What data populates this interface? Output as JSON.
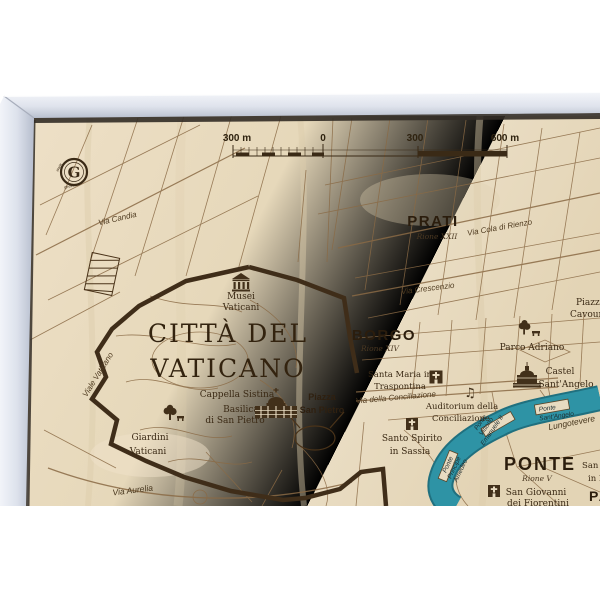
{
  "map": {
    "logo": {
      "letter": "G",
      "ring_left": "www",
      "ring_bottom": "geckoart"
    },
    "scale_bar": {
      "labels": [
        "300 m",
        "0",
        "300",
        "600 m"
      ]
    },
    "title": {
      "line1": "CITTÀ DEL",
      "line2": "VATICANO"
    },
    "districts": {
      "prati": {
        "name": "PRATI",
        "rione": "Rione XXII"
      },
      "borgo": {
        "name": "BORGO",
        "rione": "Rione XIV"
      },
      "ponte": {
        "name": "PONTE",
        "rione": "Rione V"
      },
      "parione": {
        "name": "PARIONE"
      }
    },
    "streets": {
      "via_candia": "Via Candia",
      "via_cola_di_rienzo": "Via Cola di Rienzo",
      "via_crescenzio": "Via Crescenzio",
      "viale_vaticano": "Viale Vaticano",
      "via_della_conciliazione": "Via della Conciliazione",
      "via_aurelia": "Via Aurelia",
      "lungotevere": "Lungotevere"
    },
    "bridges": {
      "vittorio_emanuele": {
        "line1": "Ponte",
        "line2": "Vittorio",
        "line3": "Emanuele II"
      },
      "sant_angelo": {
        "line1": "Ponte",
        "line2": "Sant'Angelo"
      },
      "principe_amedeo": {
        "line1": "Ponte",
        "line2": "Principe",
        "line3": "Amedeo"
      }
    },
    "pois": {
      "musei_vaticani": {
        "line1": "Musei",
        "line2": "Vaticani"
      },
      "cappella_sistina": {
        "line1": "Cappella Sistina"
      },
      "basilica_san_pietro": {
        "line1": "Basilica",
        "line2": "di San Pietro"
      },
      "piazza_san_pietro": {
        "line1": "Piazza",
        "line2": "San Pietro"
      },
      "giardini_vaticani": {
        "line1": "Giardini",
        "line2": "Vaticani"
      },
      "santa_maria_traspontina": {
        "line1": "Santa Maria in",
        "line2": "Traspontina"
      },
      "auditorium_conciliazione": {
        "line1": "Auditorium della",
        "line2": "Conciliazione"
      },
      "santo_spirito_sassia": {
        "line1": "Santo Spirito",
        "line2": "in Sassia"
      },
      "parco_adriano": {
        "line1": "Parco Adriano"
      },
      "castel_sant_angelo": {
        "line1": "Castel",
        "line2": "Sant'Angelo"
      },
      "san_giovanni_fiorentini": {
        "line1": "San Giovanni",
        "line2": "dei Fiorentini"
      },
      "piazza_cavour": {
        "line1": "Piazza",
        "line2": "Cavour"
      },
      "san_salvatore_lauro": {
        "line1": "San Salvatore",
        "line2": "in Lauro"
      }
    },
    "icons": {
      "music_note": "♫"
    },
    "colors": {
      "wood": "#e8dabd",
      "ink": "#3a2a16",
      "river": "#2e93a5",
      "frame_light": "#f0f2f7",
      "frame_dark": "#c3c9d6"
    }
  }
}
